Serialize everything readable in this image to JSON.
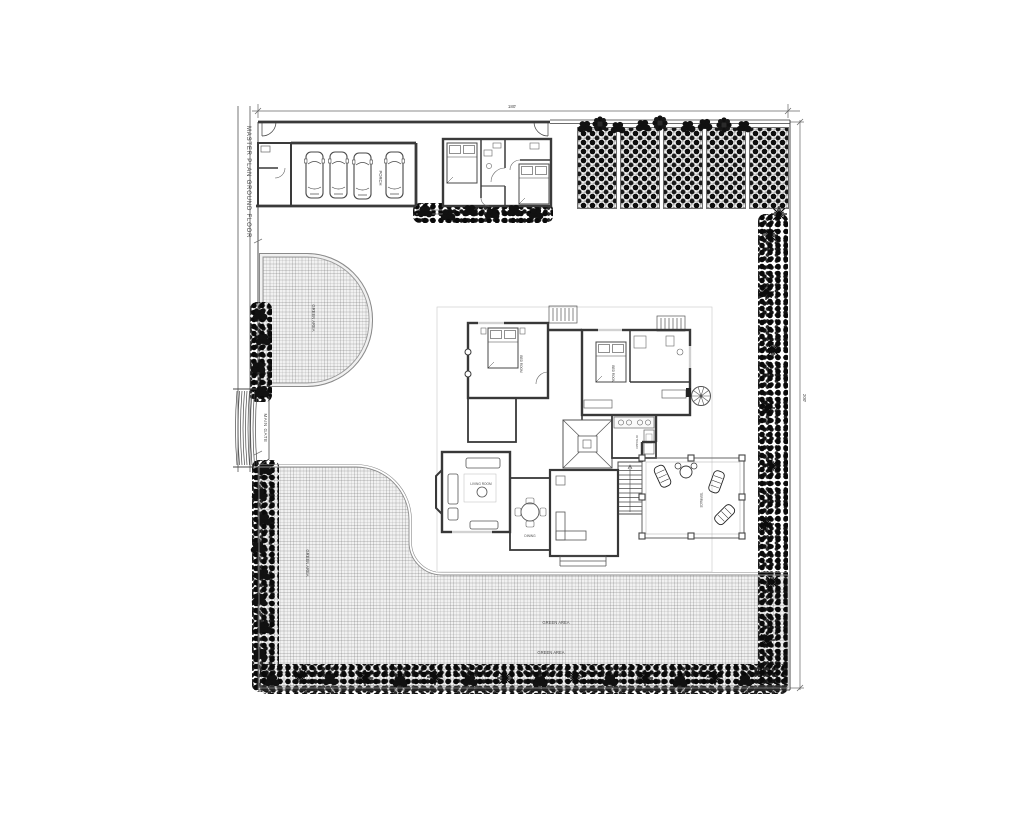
{
  "drawing": {
    "title": "MASTER PLAN GROUND FLOOR",
    "dimensions": {
      "top_width": "180'",
      "right_height": "200'"
    },
    "site": {
      "main_gate": "MAIN GATE",
      "porch": "PORCH",
      "green_area": "GREEN AREA"
    },
    "house": {
      "rooms": {
        "bedroom1": "BED ROOM",
        "bedroom2": "BED ROOM",
        "kitchen": "KITCHEN",
        "dining": "DINING",
        "living": "LIVING ROOM",
        "terrace": "TERRACE"
      }
    },
    "colors": {
      "ink": "#3a3a3a",
      "muted": "#8a8a8a",
      "foliage": "#0d0d0d",
      "grass": "#f1f1f1"
    }
  }
}
